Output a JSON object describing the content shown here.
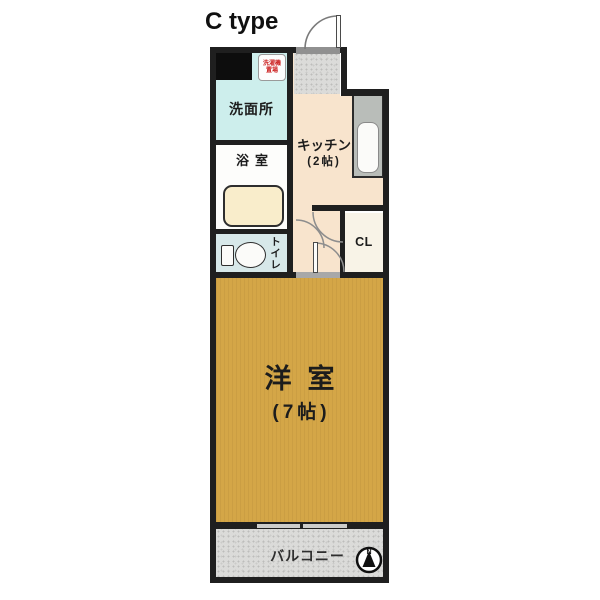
{
  "title": "C type",
  "plan": {
    "rooms": {
      "washroom": {
        "label": "洗面所"
      },
      "bathroom": {
        "label": "浴室"
      },
      "toilet": {
        "label": "トイレ"
      },
      "kitchen": {
        "label": "キッチン",
        "size": "(2帖)"
      },
      "closet": {
        "label": "CL"
      },
      "main_room": {
        "label": "洋室",
        "size": "(7帖)"
      },
      "balcony": {
        "label": "バルコニー"
      }
    },
    "fixtures": {
      "washer_note": {
        "line1": "洗濯機",
        "line2": "置場"
      },
      "compass": {
        "north_label": "N"
      }
    },
    "colors": {
      "wall": "#1f1f1f",
      "washroom_floor": "#cdeeec",
      "toilet_floor": "#d7e8e9",
      "kitchen_floor": "#f8e4cd",
      "bathroom_floor": "#fdfdfb",
      "bathtub": "#f9edcb",
      "closet_floor": "#f8f3e7",
      "main_room_floor": "#d4a647",
      "balcony_floor": "#dbdbd9",
      "counter": "#b9bdb9",
      "washer_note_text": "#cc2222",
      "sill": "#909090"
    }
  }
}
